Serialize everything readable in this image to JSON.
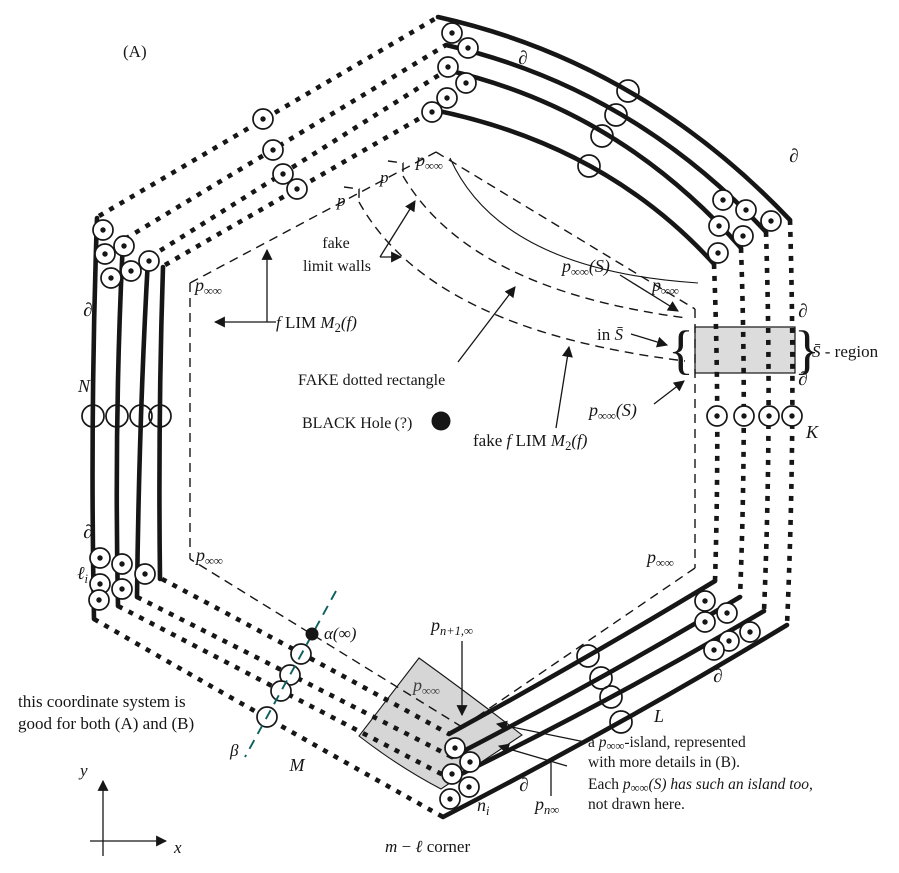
{
  "panel": {
    "label": "(A)"
  },
  "colors": {
    "ink": "#161616",
    "island_fill": "#d6d6d6",
    "sbar_fill": "#dcdcdc",
    "beta_line": "#0e5f5f",
    "dim_label": "#3f3f3f"
  },
  "math": {
    "partial": "∂",
    "p": "p",
    "inf_inf": "∞∞",
    "S_arg": "(S)",
    "N": "N",
    "K": "K",
    "L": "L",
    "M": "M",
    "ell": "ℓ",
    "sub_i": "i",
    "n": "n",
    "sub_n1_inf": "n+1,∞",
    "sub_n_inf": "n∞",
    "alpha_inf": "α(∞)",
    "beta": "β",
    "x": "x",
    "y": "y",
    "f": "f",
    "lim": " LIM ",
    "M_big": "M",
    "sub_two": "2",
    "f_arg": "(f)",
    "fake_prefix": "fake ",
    "m": "m",
    "minus": " − ",
    "corner": " corner",
    "in_prefix": "in ",
    "S_bar": "S̄",
    "region_suffix": " - region",
    "brace_left": "{",
    "brace_right": "}"
  },
  "annotations": {
    "fake_walls_line1": "fake",
    "fake_walls_line2": "limit walls",
    "fake_dotted_rectangle": "FAKE dotted rectangle",
    "black_hole": "BLACK Hole (?)",
    "island_note_1a": "a ",
    "island_note_1b": "-island, represented",
    "island_note_2": "with more details in (B).",
    "island_note_3a": "Each ",
    "island_note_3b": "(S) has such an island too,",
    "island_note_4": "not drawn here.",
    "coord_note_1": "this coordinate system is",
    "coord_note_2": "good for both (A) and (B)"
  }
}
